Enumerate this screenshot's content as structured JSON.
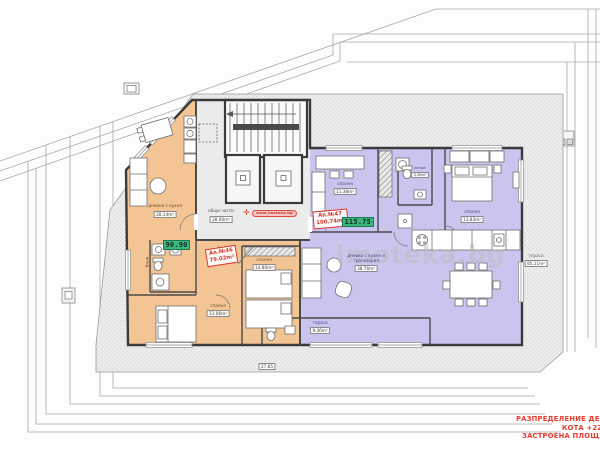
{
  "drawing": {
    "type": "apartment-floor-plan",
    "watermark": "imoteka.bg",
    "stamp": "www.imoteka.bg"
  },
  "title_block": {
    "line1": "РАЗПРЕДЕЛЕНИЕ ДЕВ",
    "line2": "КОТА +22.",
    "line3": "ЗАСТРОЕНА ПЛОЩ -"
  },
  "apartments": [
    {
      "number": "Ап.№46",
      "area": "79.02m²",
      "total": "90.90",
      "fill": "#f3c494"
    },
    {
      "number": "Ап.№47",
      "area": "100.74m²",
      "total": "115.75",
      "fill": "#c9c5ee"
    }
  ],
  "rooms": {
    "common": {
      "name": "общи части",
      "area": "28.06m²"
    },
    "o_living": {
      "name": "дневна с кухня",
      "area": "28.14m²"
    },
    "o_bath": {
      "name": "баня"
    },
    "o_bed1": {
      "name": "спалня",
      "area": "11.06m²"
    },
    "o_bed2": {
      "name": "спалня",
      "area": "14.80m²"
    },
    "p_bed1": {
      "name": "спалня",
      "area": "11.38m²"
    },
    "p_hall": {
      "name": "антре",
      "area": "3.36m²"
    },
    "p_bed2": {
      "name": "спалня",
      "area": "13.83m²"
    },
    "p_living": {
      "name1": "дневна с кухня и",
      "name2": "трапезария",
      "area": "38.76m²"
    },
    "p_terrace": {
      "name": "тераса",
      "area": "9.36m²"
    },
    "r_terrace": {
      "name": "тераса",
      "area": "85.11m²"
    }
  },
  "dimensions": {
    "bottom": "27.85"
  },
  "colors": {
    "apartment46": "#f3c494",
    "apartment47": "#c9c5ee",
    "badge_green": "#3eb57f",
    "label_red": "#d6382d",
    "notes_red": "#ee3b30"
  }
}
